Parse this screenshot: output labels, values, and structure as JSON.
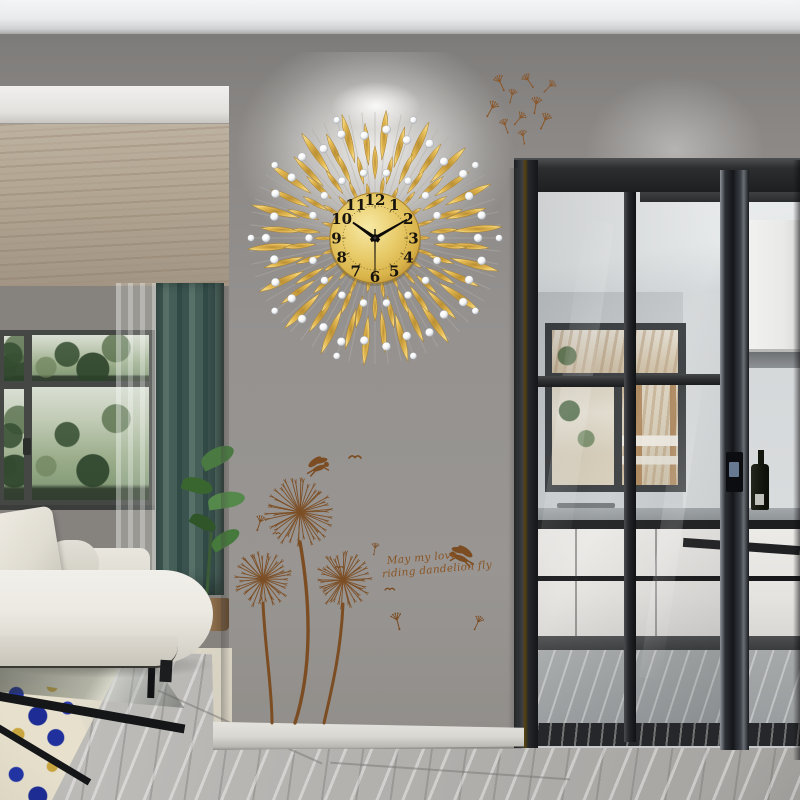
{
  "scene": {
    "description": "Modern living room: gold crystal sunburst wall clock on a grey feature wall above brown dandelion wall decals; white sofa by black-framed windows on the left; kitchen seen through black-framed sliding glass doors on the right; grey marble floor."
  },
  "clock": {
    "style": "gold sunburst dandelion wall clock with crystal beads",
    "time": "10:10:30",
    "hour": 10,
    "minute": 10,
    "second": 30,
    "numerals": [
      "1",
      "2",
      "3",
      "4",
      "5",
      "6",
      "7",
      "8",
      "9",
      "10",
      "11",
      "12"
    ],
    "colors": {
      "petal_inner": "#b98f33",
      "petal_mid": "#d3a847",
      "petal_tip": "#f2d47c",
      "petal_stroke": "#a57c2c",
      "face_center": "#f7eaa6",
      "face_mid": "#e8cb6a",
      "face_edge": "#c49738",
      "numeral": "#17130d",
      "hand": "#0d0b08",
      "crystal": "#f6f7f8",
      "crystal_shade": "#b8bdc3",
      "spoke": "#b3afa8"
    }
  },
  "decal": {
    "caption_line1": "May my love,",
    "caption_line2": "riding dandelion fly",
    "color": "#7b4a1d",
    "elements": [
      "three dandelion heads on long stems",
      "two fairy silhouettes",
      "small birds",
      "floating dandelion seeds"
    ]
  },
  "palette": {
    "wall_grey": "#908d89",
    "ceiling_white": "#f2f3f4",
    "wood_ceiling": "#b2a592",
    "curtain_teal": "#455e58",
    "sofa_cream": "#eceae3",
    "marble_grey": "#b4b2af",
    "threshold_black": "#26272a",
    "cabinet_white": "#e9e9e7",
    "door_frame_black": "#1d1f21",
    "tree_green": "#7a9370",
    "rug_blue": "#2335a6",
    "rug_gold": "#c9a63f"
  }
}
